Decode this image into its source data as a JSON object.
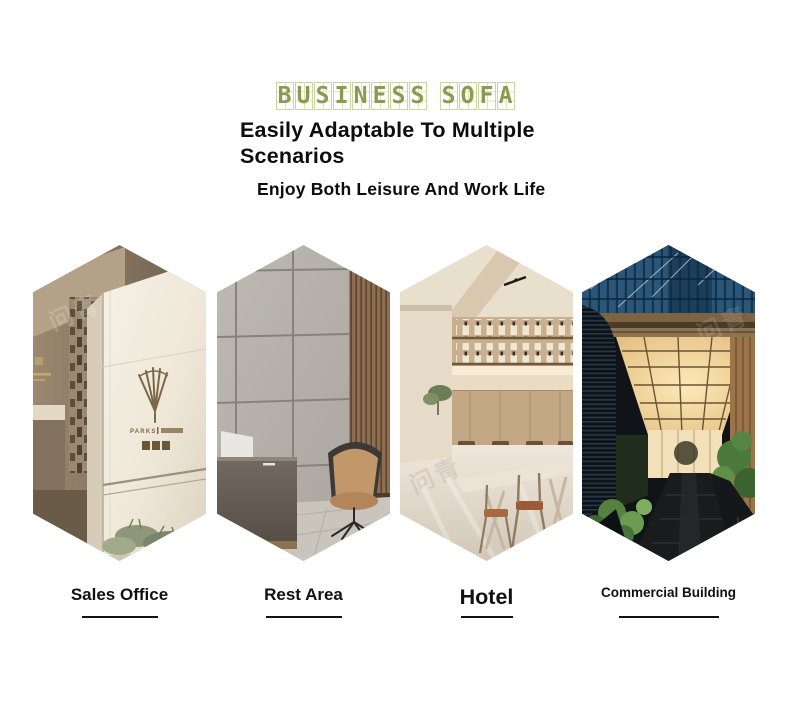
{
  "header": {
    "brand_title": "BUSINESS SOFA",
    "brand_color": "#8a9a4e",
    "heading_lines": [
      "Easily Adaptable To Multiple",
      "Scenarios"
    ],
    "subheading": "Enjoy Both Leisure And Work Life",
    "text_color": "#0d0d0d"
  },
  "scenarios": [
    {
      "label": "Sales Office",
      "image": "sales-office-stone-entrance-with-bronze-logo-and-plants"
    },
    {
      "label": "Rest Area",
      "image": "reception-lounge-grey-padded-wall-wood-slats-tan-armchair-desk"
    },
    {
      "label": "Hotel",
      "image": "hotel-bar-restaurant-warm-interior-counter-stools-tables"
    },
    {
      "label": "Commercial Building",
      "image": "commercial-building-entrance-blue-glass-facade-lit-canopy-walkway"
    }
  ],
  "underline_color": "#111111",
  "watermark": {
    "text": "问青"
  }
}
